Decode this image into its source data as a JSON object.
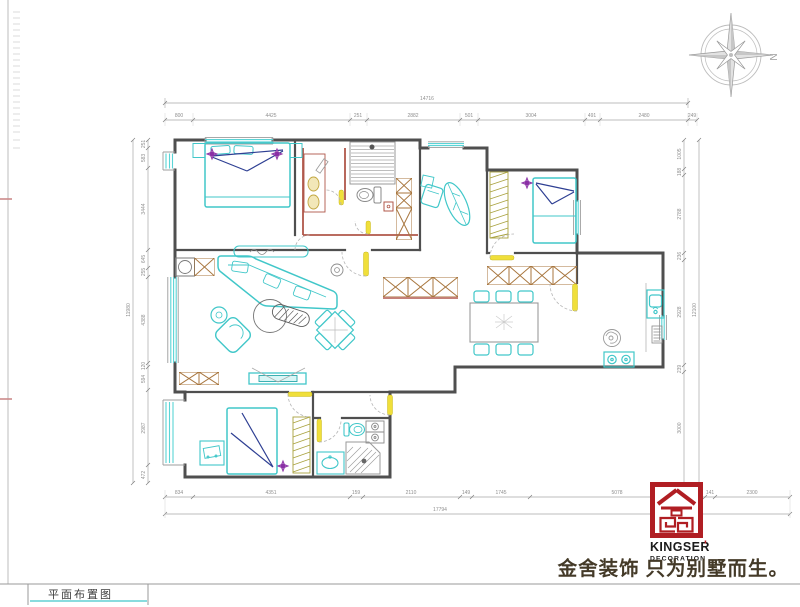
{
  "sheet": {
    "title_label": "平面布置图"
  },
  "compass": {
    "label": "N"
  },
  "logo": {
    "brand": "KINGSER",
    "apostrophe": "'",
    "sub": "DECORATION",
    "tagline": "金舍装饰 只为别墅而生。",
    "red": "#B01E23"
  },
  "dims": {
    "top": {
      "total": "14716",
      "segments": [
        "800",
        "4425",
        "251",
        "2882",
        "501",
        "3004",
        "491",
        "2480",
        "249"
      ]
    },
    "bottom": {
      "total": "17794",
      "segments": [
        "834",
        "4351",
        "159",
        "2110",
        "149",
        "1745",
        "5078",
        "141",
        "2300"
      ]
    },
    "left": {
      "total": "11980",
      "segments": [
        "251",
        "583",
        "3444",
        "645",
        "255",
        "4388",
        "120",
        "594",
        "2987",
        "472"
      ]
    },
    "right": {
      "total": "12100",
      "segments": [
        "1005",
        "188",
        "2788",
        "236",
        "2928",
        "239",
        "3000"
      ]
    }
  },
  "colors": {
    "wall": "#4f4f4f",
    "furniture_cyan": "#41c7c9",
    "window_cyan": "#5ad4d6",
    "door_yellow": "#f0df3a",
    "bath_wall": "#b0574a",
    "cabinet_brown": "#a8763e",
    "wardrobe_olive": "#a9a23e",
    "bed_navy": "#2e3f93",
    "symbol_purple": "#8a2fa5",
    "logo_red": "#B01E23",
    "dim_gray": "#9a9a9a"
  }
}
